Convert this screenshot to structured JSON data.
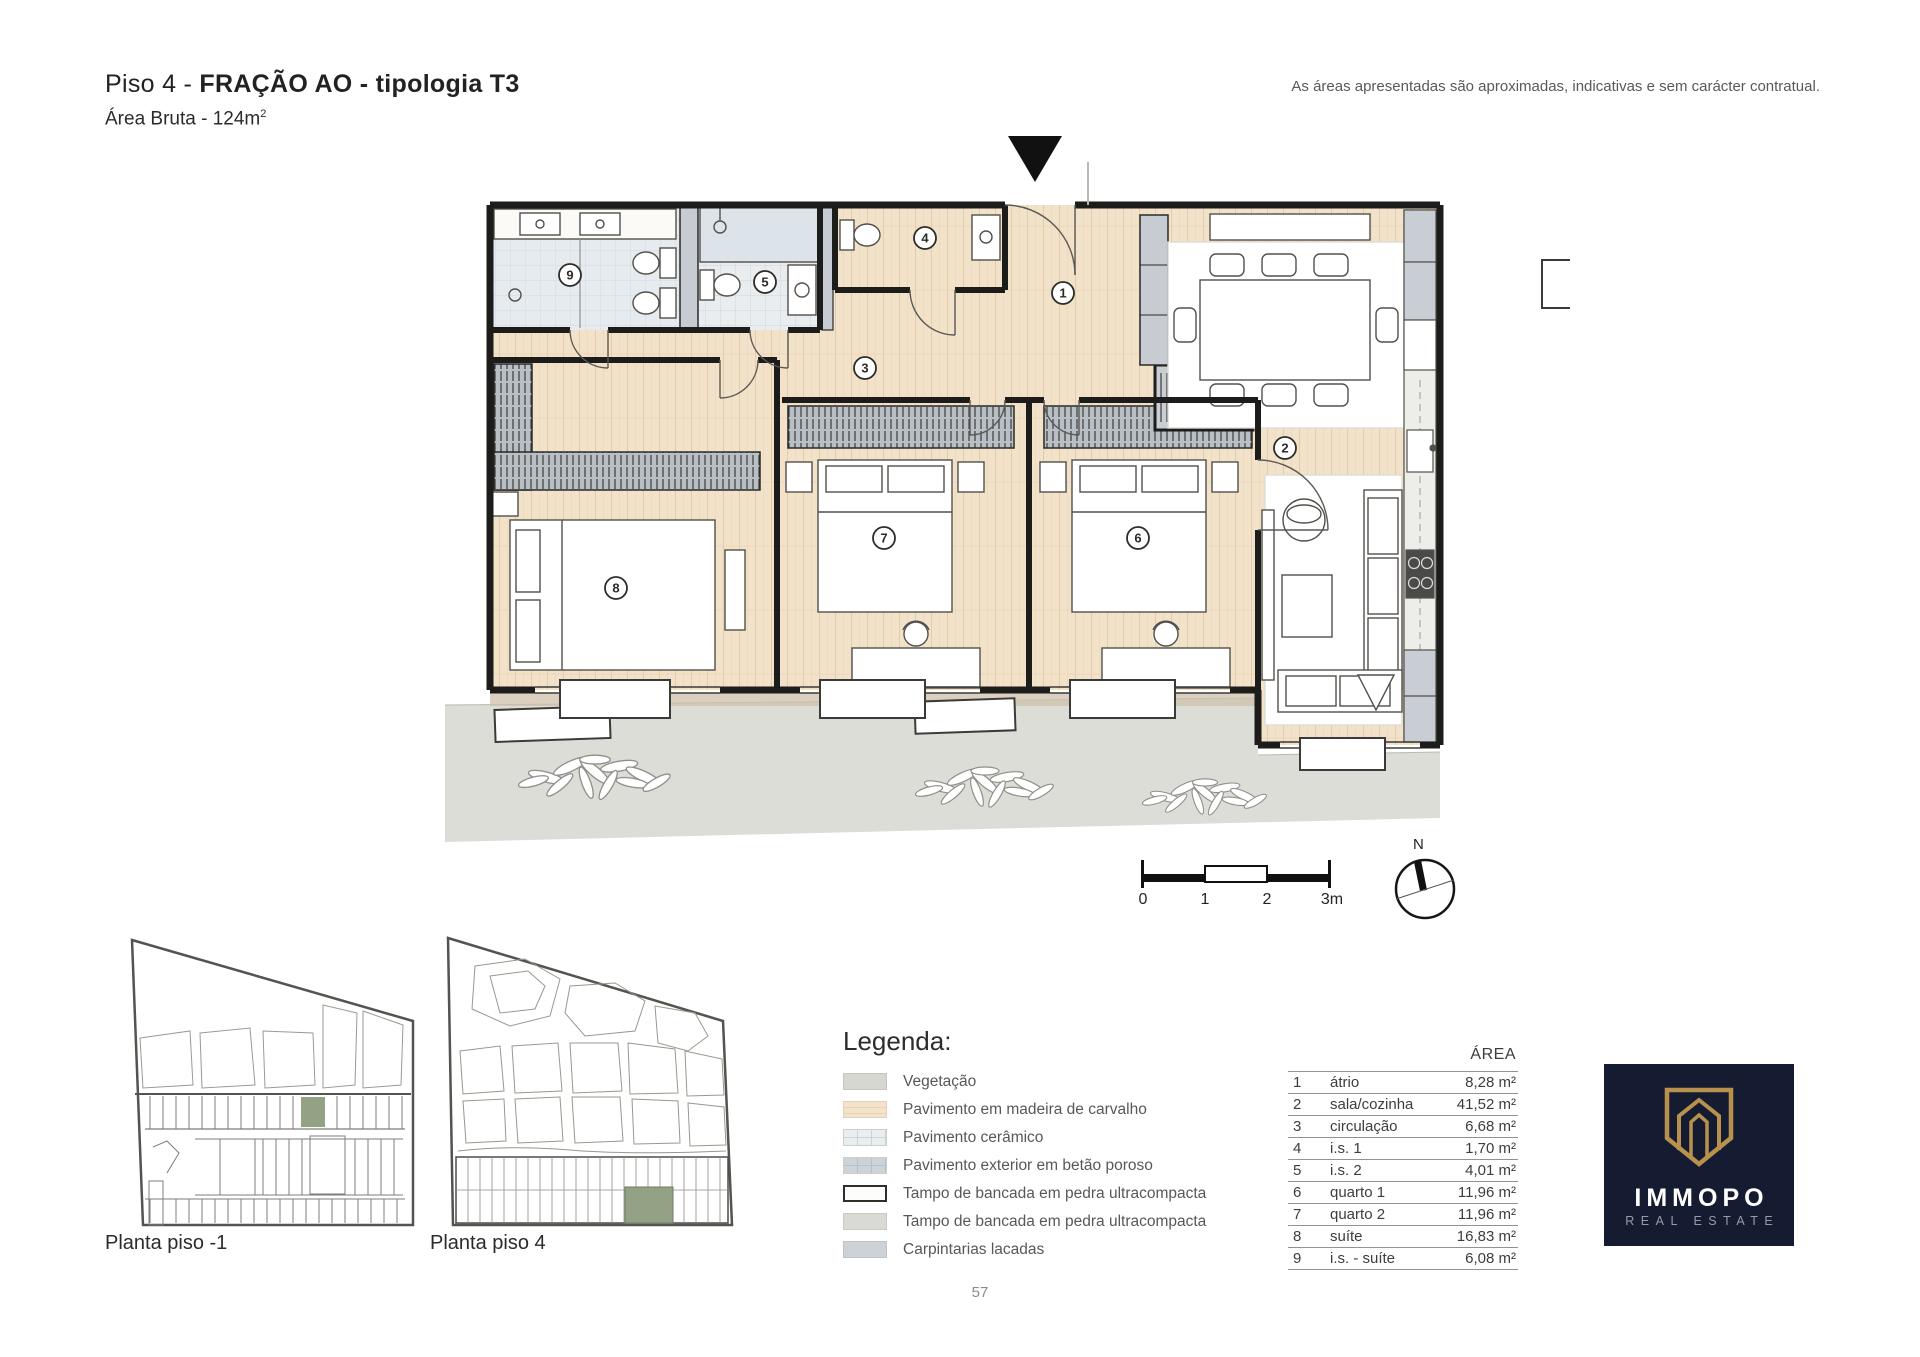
{
  "header": {
    "title_prefix": "Piso 4 - ",
    "title_bold": "FRAÇÃO AO - tipologia T3",
    "area_label": "Área Bruta - 124m",
    "area_superscript": "2",
    "disclaimer": "As áreas apresentadas são aproximadas, indicativas e sem carácter contratual."
  },
  "floor_plan": {
    "room_numbers": {
      "r1": "1",
      "r2": "2",
      "r3": "3",
      "r4": "4",
      "r5": "5",
      "r6": "6",
      "r7": "7",
      "r8": "8",
      "r9": "9"
    },
    "scale_bar_labels": [
      "0",
      "1",
      "2",
      "3m"
    ],
    "compass_north": "N"
  },
  "mini_plans": {
    "plan_minus1_label": "Planta piso -1",
    "plan_4_label": "Planta piso 4"
  },
  "legend": {
    "title": "Legenda:",
    "items": [
      {
        "label": "Vegetação",
        "swatch": "vegetation"
      },
      {
        "label": "Pavimento em madeira de carvalho",
        "swatch": "oak-wood"
      },
      {
        "label": "Pavimento cerâmico",
        "swatch": "ceramic"
      },
      {
        "label": "Pavimento exterior em betão poroso",
        "swatch": "porous-concrete"
      },
      {
        "label": "Tampo de bancada em pedra ultracompacta",
        "swatch": "stone-white"
      },
      {
        "label": "Tampo de bancada em pedra ultracompacta",
        "swatch": "stone-grey"
      },
      {
        "label": "Carpintarias lacadas",
        "swatch": "lacquered-carpentry"
      }
    ]
  },
  "area_table": {
    "header": "ÁREA",
    "rows": [
      {
        "num": "1",
        "name": "átrio",
        "area": "8,28 m²"
      },
      {
        "num": "2",
        "name": "sala/cozinha",
        "area": "41,52 m²"
      },
      {
        "num": "3",
        "name": "circulação",
        "area": "6,68 m²"
      },
      {
        "num": "4",
        "name": "i.s. 1",
        "area": "1,70 m²"
      },
      {
        "num": "5",
        "name": "i.s. 2",
        "area": "4,01 m²"
      },
      {
        "num": "6",
        "name": "quarto 1",
        "area": "11,96 m²"
      },
      {
        "num": "7",
        "name": "quarto 2",
        "area": "11,96 m²"
      },
      {
        "num": "8",
        "name": "suíte",
        "area": "16,83 m²"
      },
      {
        "num": "9",
        "name": "i.s. - suíte",
        "area": "6,08 m²"
      }
    ]
  },
  "logo": {
    "brand": "IMMOPO",
    "tagline": "REAL ESTATE"
  },
  "page": {
    "number": "57"
  },
  "colors": {
    "wood_floor": "#f3e2ca",
    "ceramic_floor": "#e9edf0",
    "exterior_concrete": "#dcddd6",
    "vegetation_grey": "#d6d7cf",
    "carpentry_grey": "#ccd1d6",
    "wall": "#1c1c1a",
    "unit_highlight_green": "#93a284",
    "logo_navy": "#151c31",
    "logo_gold": "#b9914f"
  }
}
